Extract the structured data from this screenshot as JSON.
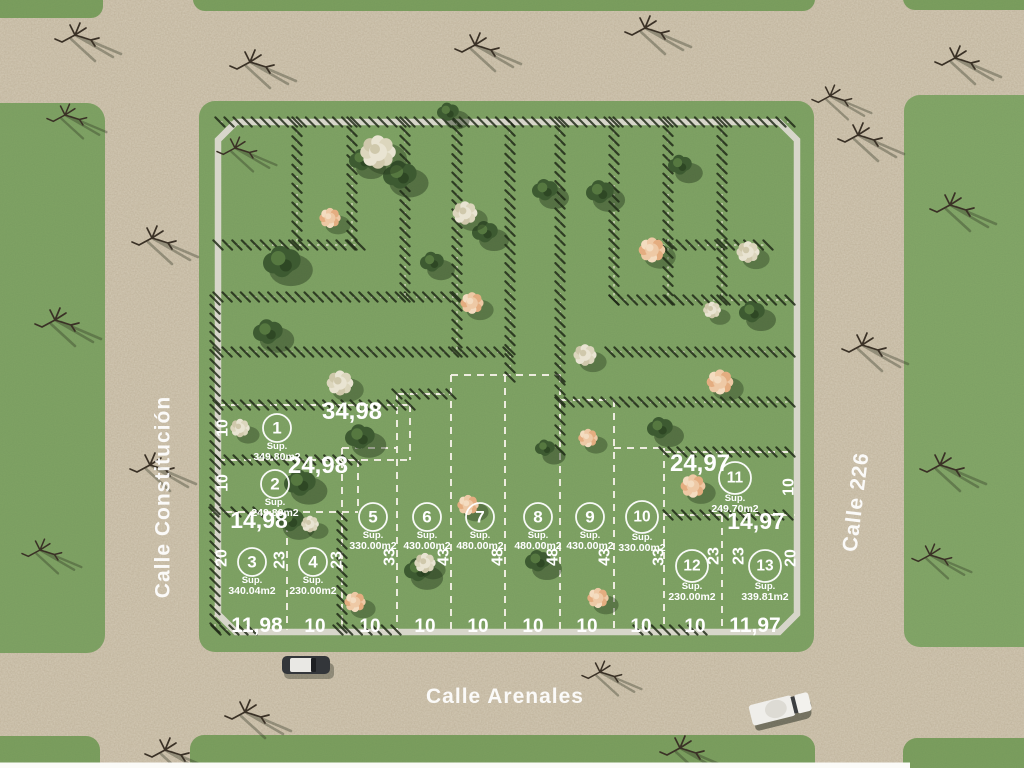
{
  "plan": {
    "streets": {
      "left": "Calle Constitución",
      "bottom": "Calle Arenales",
      "right": "Calle 226"
    },
    "sup_label": "Sup.",
    "lots": [
      {
        "number": "1",
        "area": "349.80m2"
      },
      {
        "number": "2",
        "area": "249.80m2"
      },
      {
        "number": "3",
        "area": "340.04m2"
      },
      {
        "number": "4",
        "area": "230.00m2"
      },
      {
        "number": "5",
        "area": "330.00m2"
      },
      {
        "number": "6",
        "area": "430.00m2"
      },
      {
        "number": "7",
        "area": "480.00m2"
      },
      {
        "number": "8",
        "area": "480.00m2"
      },
      {
        "number": "9",
        "area": "430.00m2"
      },
      {
        "number": "10",
        "area": "330.00m2"
      },
      {
        "number": "11",
        "area": "249.70m2"
      },
      {
        "number": "12",
        "area": "230.00m2"
      },
      {
        "number": "13",
        "area": "339.81m2"
      }
    ],
    "frontage_dims": [
      "34,98",
      "24,98",
      "14,98",
      "11,98",
      "24,97",
      "14,97",
      "11,97"
    ],
    "bottom_dims": [
      "10",
      "10",
      "10",
      "10",
      "10",
      "10",
      "10",
      "10"
    ],
    "side_dims": [
      "10",
      "10",
      "20",
      "23",
      "23",
      "33",
      "43",
      "48",
      "48",
      "43",
      "33",
      "23",
      "23",
      "10",
      "20"
    ],
    "colors": {
      "grass": "#81a465",
      "road": "#c8bca4",
      "lot_line": "#f4f1e6",
      "block_border": "#dcd9d0",
      "hatch": "#1d2715",
      "text": "#ffffff"
    }
  }
}
